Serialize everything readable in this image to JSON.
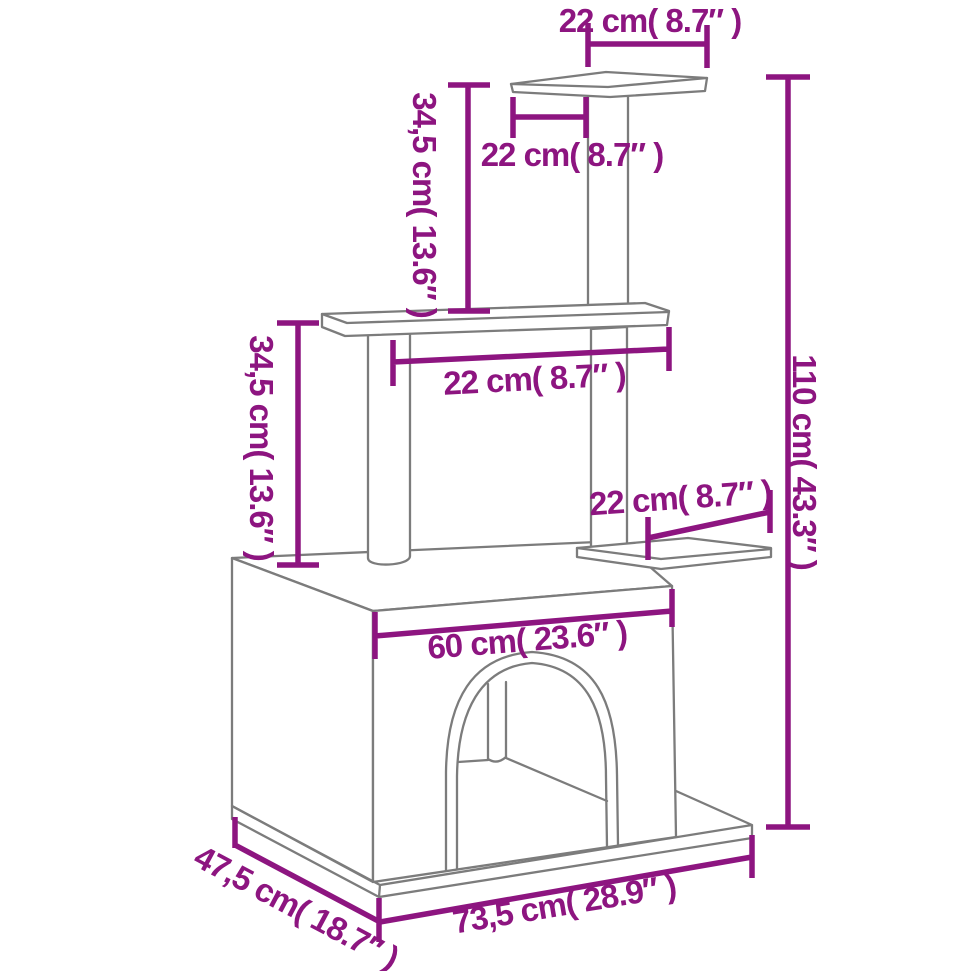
{
  "diagram": {
    "subject": "cat-tree-with-house-dimension-drawing",
    "colors": {
      "dimension": "#8d1580",
      "drawing": "#7c7c7c",
      "background": "#ffffff"
    },
    "dimensions": [
      {
        "id": "top-platform-width",
        "label": "22 cm( 8.7″ )"
      },
      {
        "id": "top-post-offset",
        "label": "22 cm( 8.7″ )"
      },
      {
        "id": "upper-section-height",
        "label": "34,5 cm( 13.6″ )"
      },
      {
        "id": "middle-platform-width",
        "label": "22 cm( 8.7″ )"
      },
      {
        "id": "middle-section-height",
        "label": "34,5 cm( 13.6″ )"
      },
      {
        "id": "total-height",
        "label": "110 cm( 43.3″ )"
      },
      {
        "id": "side-platform-width",
        "label": "22 cm( 8.7″ )"
      },
      {
        "id": "house-width",
        "label": "60 cm( 23.6″ )"
      },
      {
        "id": "base-depth",
        "label": "47,5 cm( 18.7″ )"
      },
      {
        "id": "base-width",
        "label": "73,5 cm( 28.9″ )"
      }
    ]
  }
}
